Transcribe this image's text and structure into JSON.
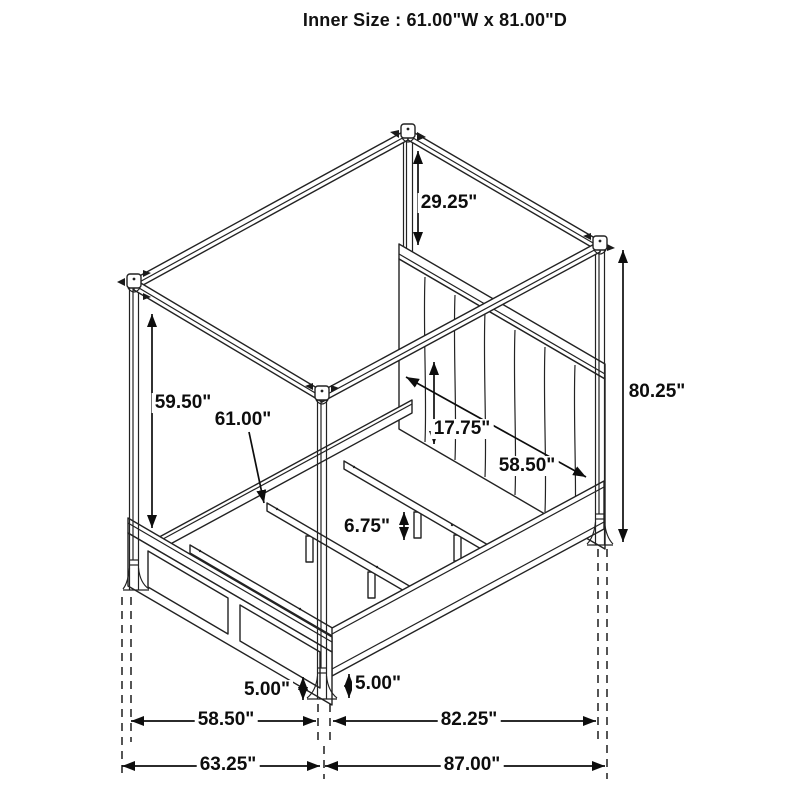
{
  "title": "Inner Size : 61.00\"W x 81.00\"D",
  "diagram": {
    "type": "isometric furniture dimension drawing",
    "subject": "canopy storage bed frame"
  },
  "labels": {
    "canopy_clearance": "29.25\"",
    "underrail_clearance": "59.50\"",
    "inner_width": "61.00\"",
    "headboard_panel_height": "17.75\"",
    "headboard_width": "58.50\"",
    "post_height": "80.25\"",
    "slat_leg_height": "6.75\"",
    "foot_height_left": "5.00\"",
    "foot_height_right": "5.00\"",
    "footboard_span": "58.50\"",
    "side_span": "82.25\"",
    "overall_width": "63.25\"",
    "overall_depth": "87.00\""
  }
}
